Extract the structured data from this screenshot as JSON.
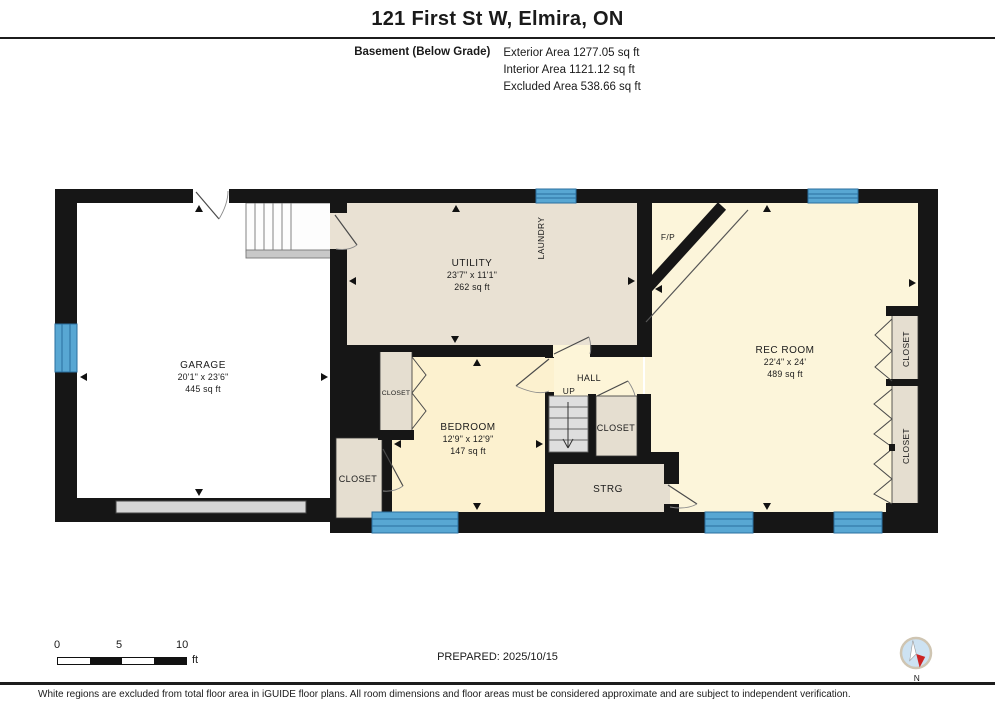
{
  "header": {
    "title": "121 First St W, Elmira, ON",
    "floor_label": "Basement (Below Grade)",
    "stats": [
      "Exterior Area 1277.05 sq ft",
      "Interior Area 1121.12 sq ft",
      "Excluded Area 538.66 sq ft"
    ]
  },
  "rooms": {
    "garage": {
      "name": "GARAGE",
      "dims": "20'1\" x 23'6\"",
      "area": "445 sq ft"
    },
    "utility": {
      "name": "UTILITY",
      "dims": "23'7\" x 11'1\"",
      "area": "262 sq ft"
    },
    "rec_room": {
      "name": "REC ROOM",
      "dims": "22'4\" x 24'",
      "area": "489 sq ft"
    },
    "bedroom": {
      "name": "BEDROOM",
      "dims": "12'9\" x 12'9\"",
      "area": "147 sq ft"
    },
    "hall": {
      "name": "HALL"
    },
    "laundry": {
      "name": "LAUNDRY"
    },
    "storage": {
      "name": "STRG"
    },
    "fireplace": {
      "name": "F/P"
    },
    "stairs_up": {
      "name": "UP"
    },
    "closets": {
      "left_upper": "CLOSET",
      "left_lower": "CLOSET",
      "hall": "CLOSET",
      "right_upper": "CLOSET",
      "right_lower": "CLOSET"
    }
  },
  "scale_bar": {
    "ticks": [
      "0",
      "5",
      "10"
    ],
    "unit": "ft"
  },
  "footer": {
    "prepared": "PREPARED: 2025/10/15",
    "disclaimer": "White regions are excluded from total floor area in iGUIDE floor plans. All room dimensions and floor areas must be considered approximate and are subject to independent verification.",
    "compass_label": "N"
  },
  "colors": {
    "wall": "#161616",
    "window": "#58a7d3",
    "window_line": "#2a6f9f",
    "room_tan": "#e9e1d3",
    "room_yellow": "#fcf5da",
    "bedroom_yellow": "#fcf1cf",
    "closet_tan": "#e5ded0",
    "stairs_gray": "#dedede",
    "compass_blue": "#cde2f2",
    "compass_red": "#cc2323"
  }
}
